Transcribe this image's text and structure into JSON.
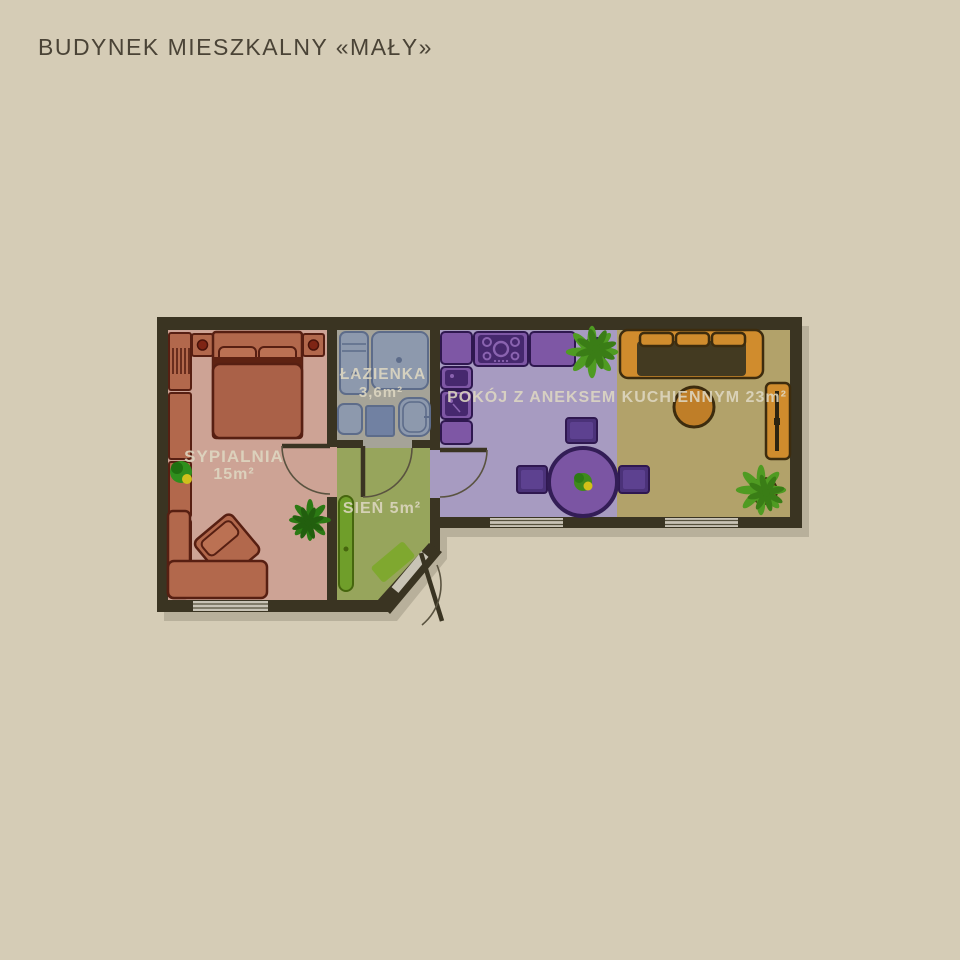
{
  "title": "BUDYNEK MIESZKALNY «MAŁY»",
  "rooms": {
    "bedroom": {
      "label": "SYPIALNIA",
      "area": "15m²"
    },
    "bathroom": {
      "label": "ŁAZIENKA",
      "area": "3,6m²"
    },
    "hall": {
      "label": "SIEŃ 5m²"
    },
    "living_kitchen": {
      "label": "POKÓJ Z ANEKSEM KUCHIENNYM 23m²"
    }
  },
  "colors": {
    "background": "#d5ccb6",
    "wall": "#3a3422",
    "title_text": "#4a4336",
    "label_text": "#ded7c2",
    "bedroom_floor": "#cda395",
    "bathroom_floor": "#a5a398",
    "hall_floor": "#97a55c",
    "kitchen_floor": "#a79bc1",
    "living_floor": "#b2a26a",
    "terracotta_furniture": "#b2684c",
    "bath_fixture_blue": "#8d99ad",
    "washing_machine_blue": "#7181a2",
    "kitchen_purple": "#7e57a5",
    "hall_cabinet_green": "#6f9e2a",
    "sofa_orange": "#d08c2d",
    "plant_green": "#4f9b22",
    "window_glass": "#c8c3b5"
  }
}
